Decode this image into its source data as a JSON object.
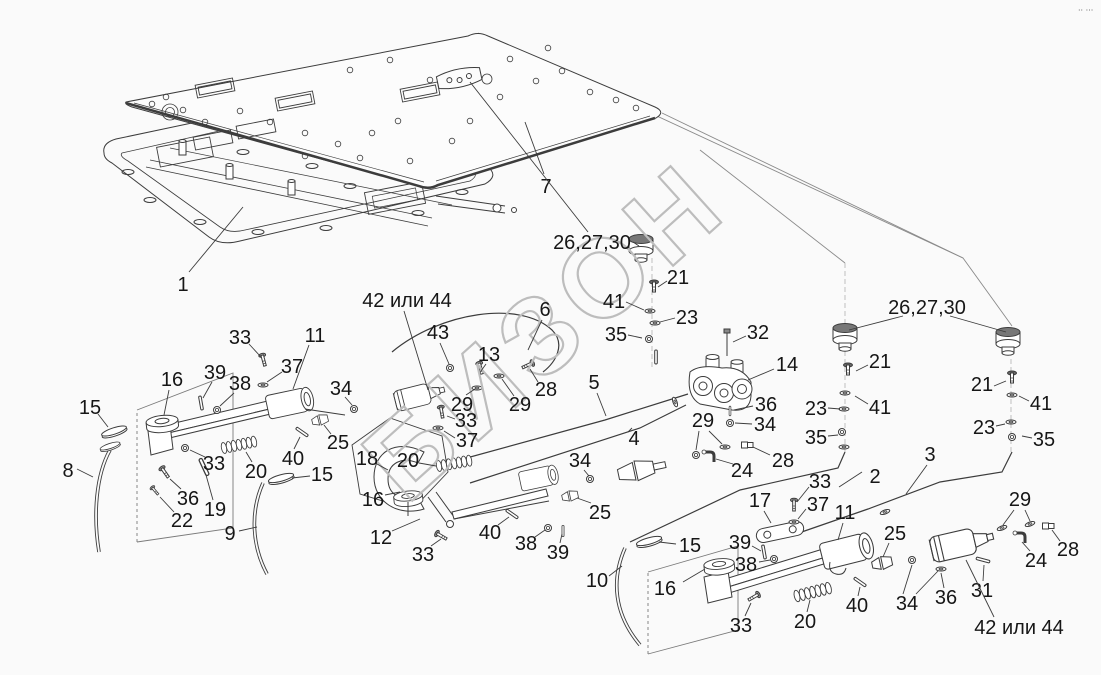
{
  "diagram": {
    "kind": "exploded-parts-drawing",
    "language": "ru"
  },
  "watermark": {
    "text": "БИЗОН"
  },
  "corner_mark": {
    "text": "·· ···"
  },
  "colors": {
    "background": "#fafafa",
    "line": "#3c3c3c",
    "construction": "#8a8a8a",
    "label_text": "#161616",
    "watermark_outline": "#bdbdbd"
  },
  "labels": [
    {
      "text": "1",
      "x": 183,
      "y": 284,
      "leaders": [
        [
          189,
          272,
          243,
          207
        ]
      ]
    },
    {
      "text": "7",
      "x": 546,
      "y": 186,
      "leaders": [
        [
          544,
          174,
          525,
          122
        ]
      ]
    },
    {
      "text": "26,27,30",
      "x": 592,
      "y": 242,
      "leaders": [
        [
          588,
          232,
          470,
          82
        ],
        [
          633,
          242,
          639,
          246
        ]
      ]
    },
    {
      "text": "21",
      "x": 678,
      "y": 277,
      "leaders": [
        [
          667,
          281,
          658,
          287
        ]
      ]
    },
    {
      "text": "41",
      "x": 614,
      "y": 301,
      "leaders": [
        [
          626,
          302,
          644,
          310
        ]
      ]
    },
    {
      "text": "23",
      "x": 687,
      "y": 317,
      "leaders": [
        [
          675,
          318,
          660,
          322
        ]
      ]
    },
    {
      "text": "35",
      "x": 616,
      "y": 334,
      "leaders": [
        [
          628,
          335,
          642,
          338
        ]
      ]
    },
    {
      "text": "32",
      "x": 758,
      "y": 332,
      "leaders": [
        [
          746,
          336,
          733,
          342
        ]
      ]
    },
    {
      "text": "26,27,30",
      "x": 927,
      "y": 307,
      "leaders": [
        [
          903,
          316,
          849,
          330
        ],
        [
          950,
          316,
          1006,
          332
        ]
      ]
    },
    {
      "text": "6",
      "x": 545,
      "y": 309,
      "leaders": [
        [
          542,
          320,
          528,
          350
        ]
      ]
    },
    {
      "text": "42 или 44",
      "x": 407,
      "y": 300,
      "leaders": [
        [
          404,
          311,
          428,
          390
        ]
      ]
    },
    {
      "text": "43",
      "x": 438,
      "y": 332,
      "leaders": [
        [
          440,
          343,
          449,
          364
        ]
      ]
    },
    {
      "text": "13",
      "x": 489,
      "y": 354,
      "leaders": [
        [
          486,
          364,
          481,
          371
        ]
      ]
    },
    {
      "text": "5",
      "x": 594,
      "y": 382,
      "leaders": [
        [
          597,
          393,
          606,
          416
        ]
      ]
    },
    {
      "text": "4",
      "x": 634,
      "y": 438,
      "leaders": [
        [
          632,
          428,
          628,
          432
        ]
      ]
    },
    {
      "text": "14",
      "x": 787,
      "y": 364,
      "leaders": [
        [
          774,
          369,
          748,
          380
        ]
      ]
    },
    {
      "text": "36",
      "x": 766,
      "y": 404,
      "leaders": [
        [
          753,
          406,
          734,
          410
        ]
      ]
    },
    {
      "text": "34",
      "x": 765,
      "y": 424,
      "leaders": [
        [
          752,
          424,
          735,
          423
        ]
      ]
    },
    {
      "text": "21",
      "x": 880,
      "y": 361,
      "leaders": [
        [
          868,
          365,
          856,
          371
        ]
      ]
    },
    {
      "text": "41",
      "x": 880,
      "y": 407,
      "leaders": [
        [
          868,
          404,
          855,
          396
        ]
      ]
    },
    {
      "text": "23",
      "x": 816,
      "y": 408,
      "leaders": [
        [
          828,
          408,
          840,
          409
        ]
      ]
    },
    {
      "text": "35",
      "x": 816,
      "y": 437,
      "leaders": [
        [
          828,
          436,
          838,
          435
        ]
      ]
    },
    {
      "text": "28",
      "x": 783,
      "y": 460,
      "leaders": [
        [
          770,
          455,
          753,
          447
        ]
      ]
    },
    {
      "text": "24",
      "x": 742,
      "y": 470,
      "leaders": [
        [
          733,
          464,
          716,
          459
        ]
      ]
    },
    {
      "text": "29",
      "x": 703,
      "y": 420,
      "leaders": [
        [
          699,
          431,
          696,
          450
        ],
        [
          709,
          431,
          722,
          444
        ]
      ]
    },
    {
      "text": "2",
      "x": 875,
      "y": 476,
      "leaders": [
        [
          862,
          472,
          839,
          487
        ]
      ]
    },
    {
      "text": "3",
      "x": 930,
      "y": 454,
      "leaders": [
        [
          927,
          465,
          906,
          494
        ]
      ]
    },
    {
      "text": "21",
      "x": 982,
      "y": 384,
      "leaders": [
        [
          994,
          386,
          1006,
          381
        ]
      ]
    },
    {
      "text": "41",
      "x": 1041,
      "y": 403,
      "leaders": [
        [
          1029,
          401,
          1019,
          396
        ]
      ]
    },
    {
      "text": "23",
      "x": 984,
      "y": 427,
      "leaders": [
        [
          996,
          426,
          1005,
          424
        ]
      ]
    },
    {
      "text": "35",
      "x": 1044,
      "y": 439,
      "leaders": [
        [
          1032,
          438,
          1022,
          436
        ]
      ]
    },
    {
      "text": "17",
      "x": 760,
      "y": 500,
      "leaders": [
        [
          764,
          511,
          771,
          523
        ]
      ]
    },
    {
      "text": "33",
      "x": 820,
      "y": 481,
      "leaders": [
        [
          809,
          487,
          797,
          502
        ]
      ]
    },
    {
      "text": "37",
      "x": 818,
      "y": 504,
      "leaders": [
        [
          806,
          509,
          798,
          519
        ]
      ]
    },
    {
      "text": "11",
      "x": 845,
      "y": 512,
      "leaders": [
        [
          843,
          523,
          838,
          540
        ]
      ]
    },
    {
      "text": "29",
      "x": 1020,
      "y": 499,
      "leaders": [
        [
          1014,
          510,
          1003,
          525
        ],
        [
          1025,
          510,
          1030,
          521
        ]
      ]
    },
    {
      "text": "24",
      "x": 1036,
      "y": 560,
      "leaders": [
        [
          1030,
          551,
          1022,
          542
        ]
      ]
    },
    {
      "text": "28",
      "x": 1068,
      "y": 549,
      "leaders": [
        [
          1060,
          541,
          1052,
          530
        ]
      ]
    },
    {
      "text": "25",
      "x": 895,
      "y": 533,
      "leaders": [
        [
          889,
          543,
          883,
          557
        ]
      ]
    },
    {
      "text": "31",
      "x": 982,
      "y": 590,
      "leaders": [
        [
          983,
          581,
          984,
          565
        ]
      ]
    },
    {
      "text": "36",
      "x": 946,
      "y": 597,
      "leaders": [
        [
          944,
          588,
          941,
          573
        ]
      ]
    },
    {
      "text": "34",
      "x": 907,
      "y": 603,
      "leaders": [
        [
          903,
          594,
          912,
          565
        ],
        [
          916,
          594,
          938,
          571
        ]
      ]
    },
    {
      "text": "42 или 44",
      "x": 1019,
      "y": 627,
      "leaders": [
        [
          994,
          617,
          966,
          560
        ]
      ]
    },
    {
      "text": "40",
      "x": 857,
      "y": 605,
      "leaders": [
        [
          858,
          596,
          860,
          587
        ]
      ]
    },
    {
      "text": "20",
      "x": 805,
      "y": 621,
      "leaders": [
        [
          807,
          612,
          810,
          600
        ]
      ]
    },
    {
      "text": "33",
      "x": 741,
      "y": 625,
      "leaders": [
        [
          745,
          616,
          751,
          603
        ]
      ]
    },
    {
      "text": "16",
      "x": 665,
      "y": 588,
      "leaders": [
        [
          683,
          582,
          705,
          569
        ]
      ]
    },
    {
      "text": "38",
      "x": 746,
      "y": 564,
      "leaders": [
        [
          759,
          562,
          770,
          560
        ]
      ]
    },
    {
      "text": "39",
      "x": 740,
      "y": 542,
      "leaders": [
        [
          752,
          546,
          761,
          551
        ]
      ]
    },
    {
      "text": "15",
      "x": 690,
      "y": 545,
      "leaders": [
        [
          676,
          544,
          659,
          542
        ]
      ]
    },
    {
      "text": "10",
      "x": 597,
      "y": 580,
      "leaders": [
        [
          609,
          576,
          622,
          566
        ]
      ]
    },
    {
      "text": "25",
      "x": 600,
      "y": 512,
      "leaders": [
        [
          591,
          503,
          577,
          498
        ]
      ]
    },
    {
      "text": "34",
      "x": 580,
      "y": 460,
      "leaders": [
        [
          584,
          470,
          589,
          476
        ]
      ]
    },
    {
      "text": "29",
      "x": 462,
      "y": 404,
      "leaders": [
        [
          466,
          395,
          475,
          389
        ]
      ]
    },
    {
      "text": "29",
      "x": 520,
      "y": 404,
      "leaders": [
        [
          514,
          396,
          502,
          379
        ]
      ]
    },
    {
      "text": "28",
      "x": 546,
      "y": 389,
      "leaders": [
        [
          538,
          382,
          530,
          369
        ]
      ]
    },
    {
      "text": "33",
      "x": 466,
      "y": 420,
      "leaders": [
        [
          455,
          419,
          447,
          416
        ]
      ]
    },
    {
      "text": "37",
      "x": 467,
      "y": 440,
      "leaders": [
        [
          455,
          438,
          444,
          431
        ]
      ]
    },
    {
      "text": "18",
      "x": 367,
      "y": 458,
      "leaders": [
        [
          377,
          464,
          388,
          470
        ]
      ]
    },
    {
      "text": "20",
      "x": 408,
      "y": 460,
      "leaders": [
        [
          419,
          463,
          436,
          466
        ]
      ]
    },
    {
      "text": "16",
      "x": 373,
      "y": 499,
      "leaders": [
        [
          385,
          495,
          400,
          492
        ]
      ]
    },
    {
      "text": "12",
      "x": 381,
      "y": 537,
      "leaders": [
        [
          392,
          531,
          420,
          519
        ]
      ]
    },
    {
      "text": "33",
      "x": 423,
      "y": 554,
      "leaders": [
        [
          431,
          546,
          441,
          539
        ]
      ]
    },
    {
      "text": "40",
      "x": 490,
      "y": 532,
      "leaders": [
        [
          498,
          525,
          509,
          517
        ]
      ]
    },
    {
      "text": "38",
      "x": 526,
      "y": 543,
      "leaders": [
        [
          535,
          537,
          545,
          530
        ]
      ]
    },
    {
      "text": "39",
      "x": 558,
      "y": 552,
      "leaders": [
        [
          560,
          543,
          562,
          534
        ]
      ]
    },
    {
      "text": "15",
      "x": 322,
      "y": 474,
      "leaders": [
        [
          310,
          476,
          292,
          478
        ]
      ]
    },
    {
      "text": "9",
      "x": 230,
      "y": 533,
      "leaders": [
        [
          239,
          531,
          257,
          527
        ]
      ]
    },
    {
      "text": "19",
      "x": 215,
      "y": 509,
      "leaders": [
        [
          213,
          500,
          206,
          475
        ]
      ]
    },
    {
      "text": "22",
      "x": 182,
      "y": 520,
      "leaders": [
        [
          174,
          512,
          160,
          497
        ]
      ]
    },
    {
      "text": "36",
      "x": 188,
      "y": 498,
      "leaders": [
        [
          181,
          489,
          170,
          479
        ]
      ]
    },
    {
      "text": "8",
      "x": 68,
      "y": 470,
      "leaders": [
        [
          77,
          469,
          93,
          477
        ]
      ]
    },
    {
      "text": "15",
      "x": 90,
      "y": 407,
      "leaders": [
        [
          98,
          414,
          108,
          427
        ]
      ]
    },
    {
      "text": "16",
      "x": 172,
      "y": 379,
      "leaders": [
        [
          169,
          390,
          164,
          415
        ]
      ]
    },
    {
      "text": "39",
      "x": 215,
      "y": 372,
      "leaders": [
        [
          212,
          382,
          203,
          398
        ]
      ]
    },
    {
      "text": "38",
      "x": 240,
      "y": 383,
      "leaders": [
        [
          234,
          393,
          220,
          406
        ]
      ]
    },
    {
      "text": "37",
      "x": 292,
      "y": 366,
      "leaders": [
        [
          282,
          372,
          267,
          382
        ]
      ]
    },
    {
      "text": "33",
      "x": 240,
      "y": 337,
      "leaders": [
        [
          249,
          344,
          261,
          357
        ]
      ]
    },
    {
      "text": "11",
      "x": 315,
      "y": 335,
      "leaders": [
        [
          309,
          345,
          293,
          389
        ]
      ]
    },
    {
      "text": "34",
      "x": 341,
      "y": 388,
      "leaders": [
        [
          345,
          397,
          352,
          405
        ]
      ]
    },
    {
      "text": "25",
      "x": 338,
      "y": 442,
      "leaders": [
        [
          331,
          434,
          324,
          425
        ]
      ]
    },
    {
      "text": "33",
      "x": 214,
      "y": 463,
      "leaders": [
        [
          205,
          457,
          190,
          450
        ]
      ]
    },
    {
      "text": "20",
      "x": 256,
      "y": 471,
      "leaders": [
        [
          252,
          462,
          246,
          452
        ]
      ]
    },
    {
      "text": "40",
      "x": 293,
      "y": 458,
      "leaders": [
        [
          294,
          449,
          300,
          437
        ]
      ]
    }
  ]
}
